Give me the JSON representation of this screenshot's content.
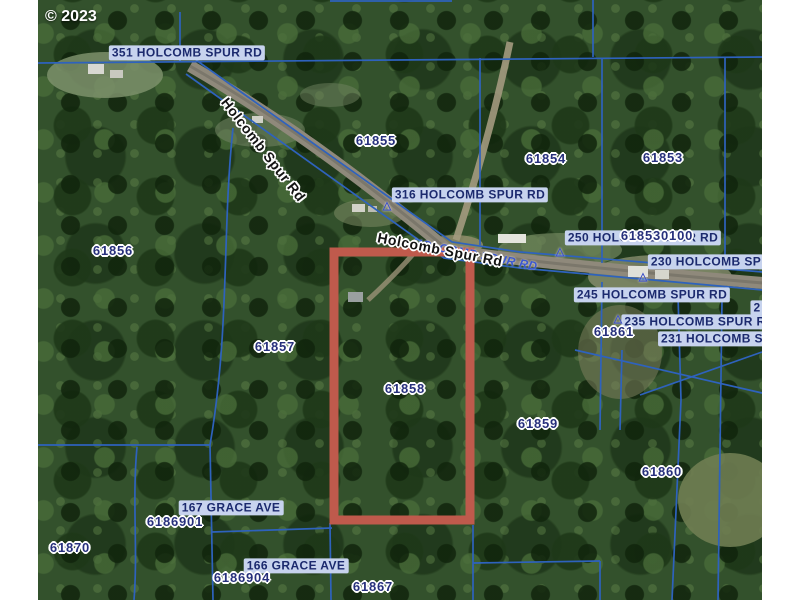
{
  "copyright": "© 2023",
  "map": {
    "colors": {
      "highlight": "#bf5a4c",
      "parcel_line": "#2e62bd",
      "pill_bg": "#c7d3ee",
      "pill_text": "#1c2a6e",
      "halo_text": "#27307c",
      "road_text": "#141414",
      "blue_road_text": "#3a57d0"
    },
    "highlight_parcel": {
      "id": "61858",
      "x": 334,
      "y": 252,
      "w": 136,
      "h": 268
    },
    "parcel_labels": [
      {
        "text": "61855",
        "x": 376,
        "y": 141
      },
      {
        "text": "61854",
        "x": 546,
        "y": 159
      },
      {
        "text": "61853",
        "x": 663,
        "y": 158
      },
      {
        "text": "61856",
        "x": 113,
        "y": 251
      },
      {
        "text": "61857",
        "x": 275,
        "y": 347
      },
      {
        "text": "618530100",
        "x": 657,
        "y": 236
      },
      {
        "text": "61861",
        "x": 614,
        "y": 332
      },
      {
        "text": "61858",
        "x": 405,
        "y": 389
      },
      {
        "text": "61859",
        "x": 538,
        "y": 424
      },
      {
        "text": "61860",
        "x": 662,
        "y": 472
      },
      {
        "text": "6186901",
        "x": 175,
        "y": 522
      },
      {
        "text": "61870",
        "x": 70,
        "y": 548
      },
      {
        "text": "6186904",
        "x": 242,
        "y": 578
      },
      {
        "text": "61867",
        "x": 373,
        "y": 587
      }
    ],
    "address_labels": [
      {
        "text": "351 HOLCOMB SPUR RD",
        "x": 187,
        "y": 53
      },
      {
        "text": "316 HOLCOMB SPUR RD",
        "x": 470,
        "y": 195
      },
      {
        "text": "250 HOLCOMB SPUR RD",
        "x": 643,
        "y": 238
      },
      {
        "text": "230 HOLCOMB SP",
        "x": 706,
        "y": 262
      },
      {
        "text": "245 HOLCOMB SPUR RD",
        "x": 652,
        "y": 295
      },
      {
        "text": "2",
        "x": 757,
        "y": 308
      },
      {
        "text": "235 HOLCOMB SPUR R",
        "x": 695,
        "y": 322
      },
      {
        "text": "231 HOLCOMB S",
        "x": 712,
        "y": 339
      },
      {
        "text": "167 GRACE AVE",
        "x": 231,
        "y": 508
      },
      {
        "text": "166 GRACE AVE",
        "x": 296,
        "y": 566
      }
    ],
    "road_labels": [
      {
        "text": "HOLCOMB SPUR RD",
        "x": 475,
        "y": 255,
        "rotate": 11,
        "style": "blue"
      },
      {
        "text": "Holcomb Spur Rd",
        "x": 263,
        "y": 150,
        "rotate": 52,
        "style": "black"
      },
      {
        "text": "Holcomb Spur Rd",
        "x": 440,
        "y": 250,
        "rotate": 11,
        "style": "black"
      }
    ],
    "markers": [
      {
        "x": 387,
        "y": 206
      },
      {
        "x": 560,
        "y": 252
      },
      {
        "x": 643,
        "y": 277
      },
      {
        "x": 618,
        "y": 319
      }
    ]
  }
}
